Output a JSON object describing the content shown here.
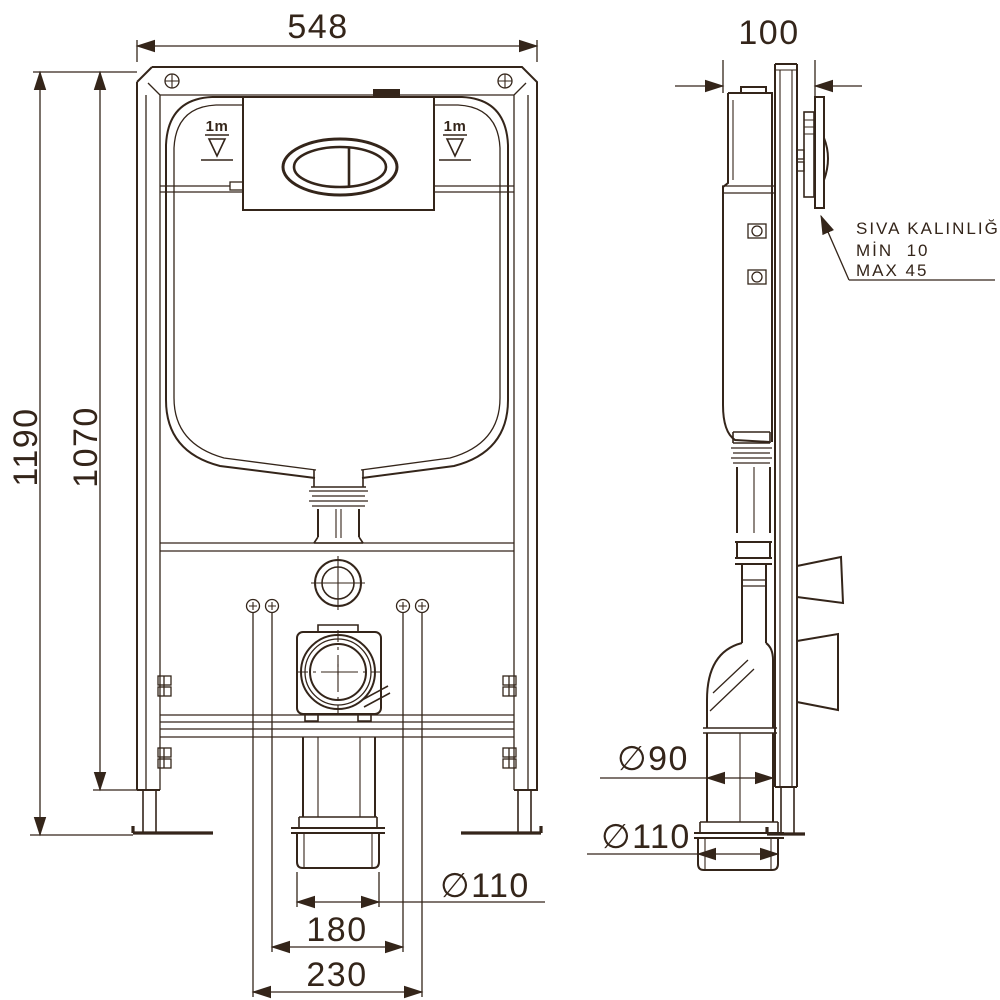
{
  "drawing": {
    "type": "technical-installation-diagram",
    "subject": "concealed cistern WC frame — front and side views",
    "colors": {
      "line": "#34251a",
      "background": "#ffffff"
    },
    "front_view": {
      "dim_width_top": "548",
      "dim_height_overall": "1190",
      "dim_height_frame": "1070",
      "dim_outlet_diameter": "∅110",
      "dim_fixing_spacing_inner": "180",
      "dim_fixing_spacing_outer": "230",
      "level_marker": "1m"
    },
    "side_view": {
      "dim_depth_top": "100",
      "dim_flush_bend_diameter": "∅90",
      "dim_outlet_diameter": "∅110",
      "annotation_line1": "SIVA KALINLIĞI",
      "annotation_line2": "MİN  10",
      "annotation_line3": "MAX 45"
    }
  }
}
